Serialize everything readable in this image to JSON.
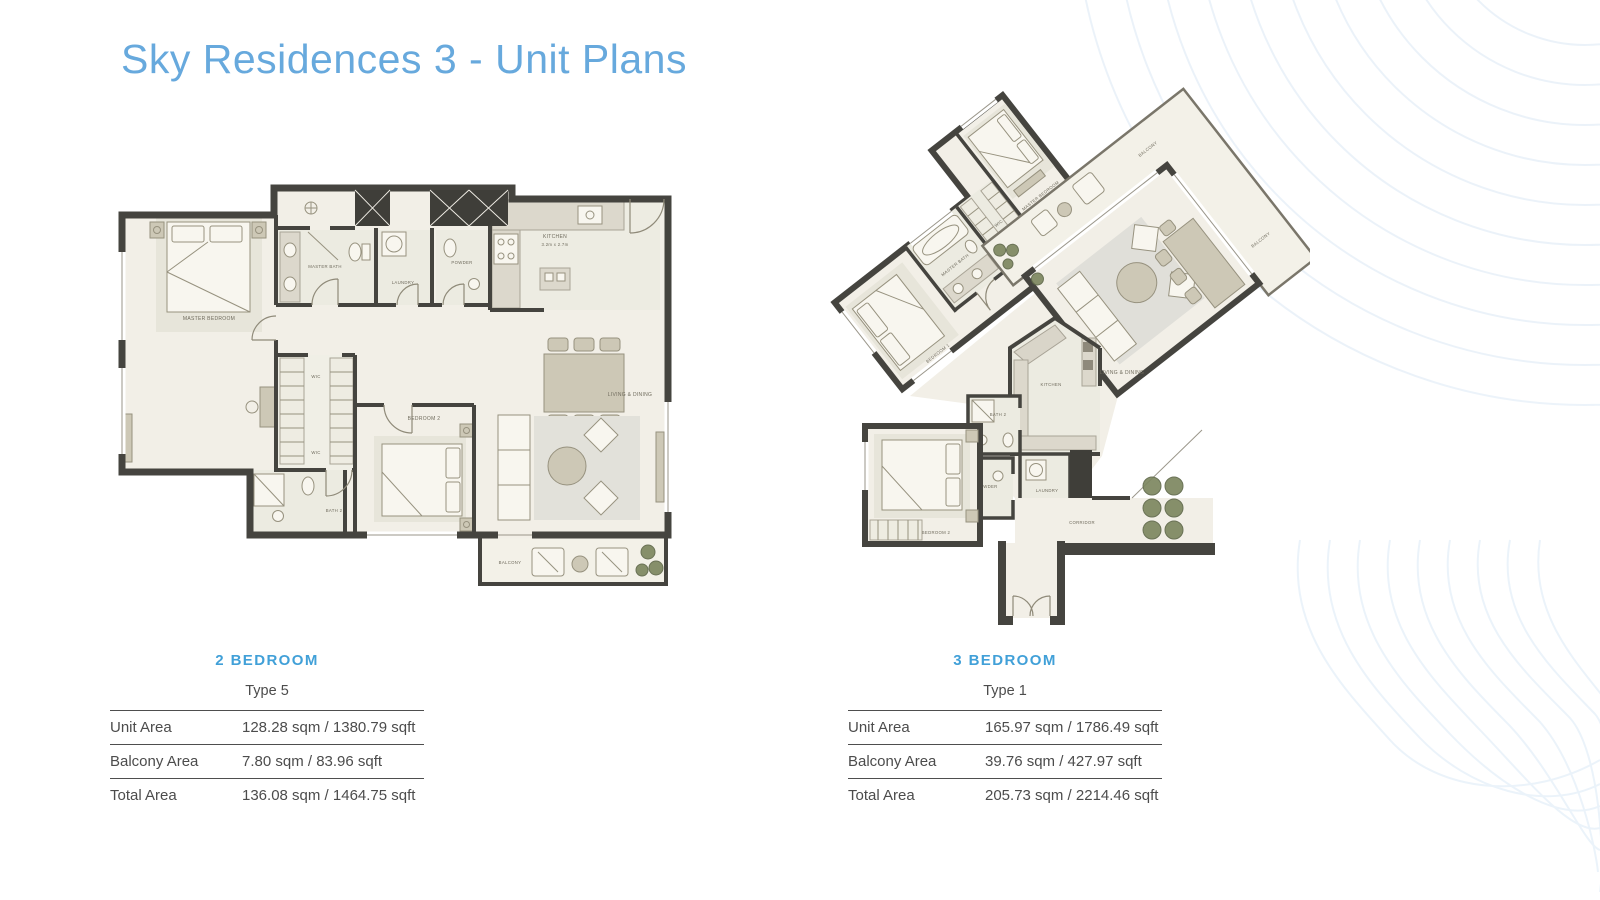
{
  "page": {
    "title": "Sky Residences 3 - Unit Plans"
  },
  "colors": {
    "title_blue": "#67a9dd",
    "heading_blue": "#41a0d8",
    "text_dark": "#4c4c4c",
    "wall_dark": "#45443f",
    "floor_cream": "#f2efe7",
    "furniture_beige": "#cdc8b6",
    "counter_gray": "#dcd8cc",
    "rug_gray": "#e0dfd9",
    "plant_green": "#7d8760",
    "decor_line_blue": "#dce9f5"
  },
  "plans": [
    {
      "heading": "2 BEDROOM",
      "type_label": "Type 5",
      "rows": [
        {
          "label": "Unit Area",
          "value": "128.28 sqm / 1380.79 sqft"
        },
        {
          "label": "Balcony Area",
          "value": "7.80 sqm / 83.96 sqft"
        },
        {
          "label": "Total Area",
          "value": "136.08 sqm / 1464.75 sqft"
        }
      ],
      "room_labels": {
        "master_bedroom": "MASTER BEDROOM",
        "master_bath": "MASTER BATH",
        "laundry": "LAUNDRY",
        "powder": "POWDER",
        "kitchen": "KITCHEN",
        "kitchen_dims": "3.2m x 2.7m",
        "wic": "WIC",
        "bedroom2": "BEDROOM 2",
        "bath2": "BATH 2",
        "living": "LIVING & DINING",
        "balcony": "BALCONY"
      }
    },
    {
      "heading": "3 BEDROOM",
      "type_label": "Type 1",
      "rows": [
        {
          "label": "Unit Area",
          "value": "165.97 sqm / 1786.49 sqft"
        },
        {
          "label": "Balcony Area",
          "value": "39.76 sqm / 427.97 sqft"
        },
        {
          "label": "Total Area",
          "value": "205.73 sqm / 2214.46 sqft"
        }
      ],
      "room_labels": {
        "master_bedroom": "MASTER BEDROOM",
        "master_bath": "MASTER BATH",
        "wic": "WIC",
        "bedroom1": "BEDROOM 1",
        "bedroom2": "BEDROOM 2",
        "bath2": "BATH 2",
        "powder": "POWDER",
        "laundry": "LAUNDRY",
        "kitchen": "KITCHEN",
        "living": "LIVING & DINING",
        "balcony": "BALCONY",
        "corridor": "CORRIDOR"
      }
    }
  ]
}
